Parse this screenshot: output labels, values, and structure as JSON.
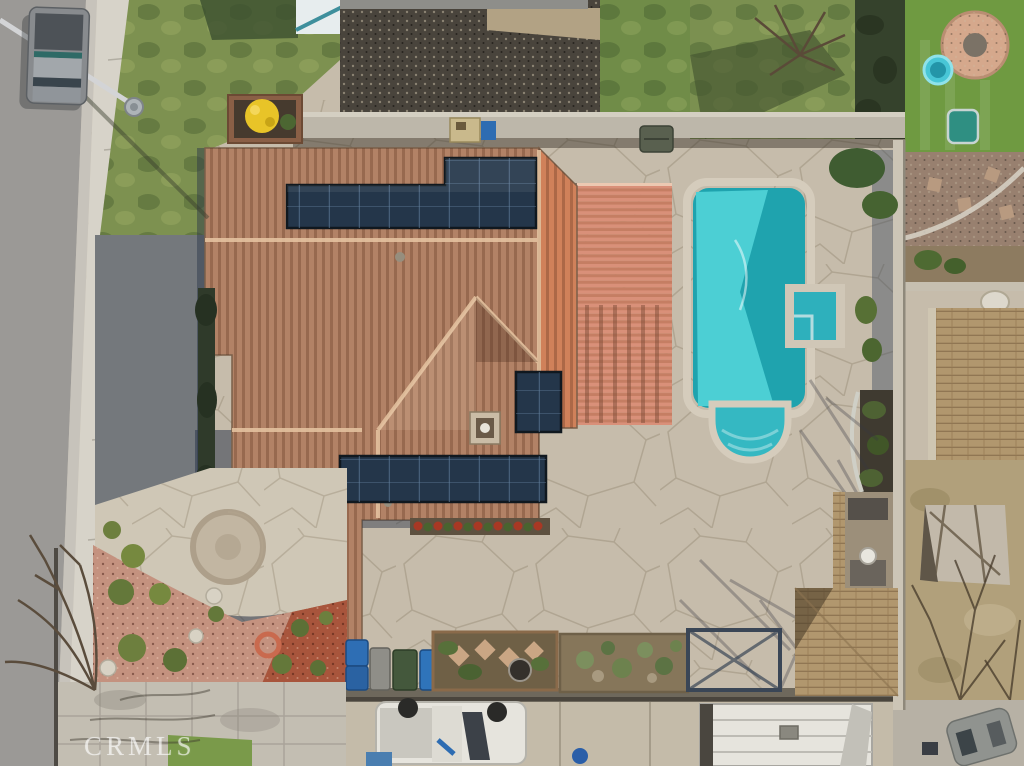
{
  "scene": {
    "description": "Aerial top-down drone photo of a single-family home: Spanish tile roof with three rooftop solar arrays, backyard swimming pool with attached spa, salmon lattice patio cover, stamped-concrete patio, front yard with curved walkway and red/pink rock mulch, street with parked pickup, driveway with white pickup truck, trash bins, raised garden beds, wood-shingle shed, RV trailer, and neighboring yards (artificial turf with fire-pit circle and kiddie pool at top right).",
    "watermark": "CRMLS",
    "objects": {
      "street": "asphalt street",
      "sidewalk": "concrete sidewalk",
      "front_lawn": "green front lawn",
      "parked_truck": "gray pickup parked on street",
      "streetlight": "streetlight pole and shadow",
      "house_roof": "tan Spanish tile hip roof",
      "solar_arrays": "three dark rooftop solar panel arrays",
      "patio_cover": "salmon slatted patio cover",
      "pool": "turquoise swimming pool with step bulge",
      "spa": "square attached spa",
      "patio": "stamped concrete flagstone patio",
      "back_wall": "concrete block rear wall",
      "yellow_bush": "yellow flowering shrub in planter",
      "front_walkway": "curved walkway with circular medallion",
      "mulch_beds": "pink and red rock mulch with shrubs",
      "satellite_dish": "satellite dish",
      "garden_beds": "raised garden beds with pavers and succulents",
      "trash_bins": "blue, gray and green bins",
      "driveway_truck": "white pickup truck in rear driveway",
      "rv_trailer": "white RV trailer roof",
      "shed": "wood shingle shed with outdoor kitchen",
      "neighbor_turf": "neighbor artificial turf with paver fire-pit circle, kiddie pool and teal sandbox",
      "neighbor_yard_right": "dry neighbor yard with tarp-covered equipment and bare trees",
      "bare_trees": "leafless winter trees"
    },
    "palette": {
      "street": "#9b9996",
      "gutter": "#c7c3bb",
      "sidewalk": "#d7d3c9",
      "lawn": "#7d9150",
      "lawn_dark": "#3c5030",
      "gravel": "#49443c",
      "patio": "#c6bcab",
      "concrete_warm": "#c4bba9",
      "wall": "#bdb7aa",
      "roof": "#b28266",
      "roof_sun": "#d0815a",
      "cover": "#d8917a",
      "pool": "#1fa3ae",
      "pool_light": "#4ccfd4",
      "spa": "#2eb0bc",
      "coping": "#d5ccbc",
      "solar": "#24364a",
      "mulch_pink": "#c4927f",
      "mulch_red": "#a8553c",
      "turf": "#6f9a41",
      "shed": "#b1976e",
      "dry_yard": "#b1a07b",
      "shadow_blue": "#2e3c52",
      "truck_white": "#e6e4dd"
    }
  }
}
